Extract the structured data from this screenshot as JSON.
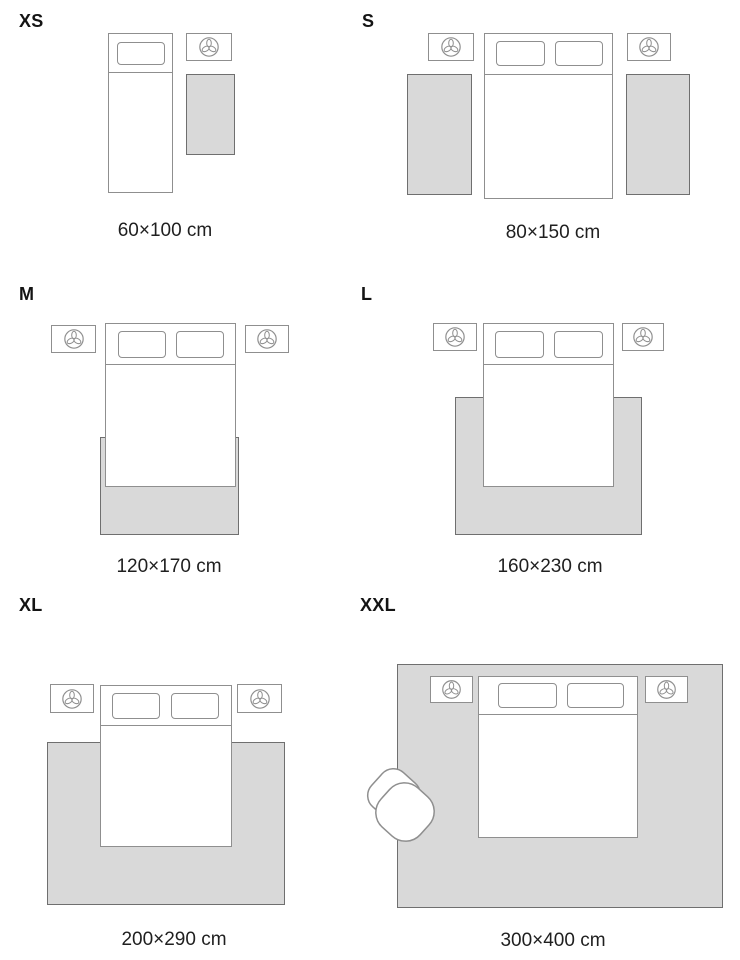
{
  "colors": {
    "background": "#ffffff",
    "rug_fill": "#d9d9d9",
    "rug_border": "#6f6f6f",
    "furniture_outline": "#8f8f8f",
    "text": "#1f1f1f"
  },
  "icons": {
    "nightstand_icon": "plant-icon",
    "armchair": "armchair"
  },
  "sizes": [
    {
      "label": "XS",
      "dimension": "60×100 cm"
    },
    {
      "label": "S",
      "dimension": "80×150 cm"
    },
    {
      "label": "M",
      "dimension": "120×170 cm"
    },
    {
      "label": "L",
      "dimension": "160×230 cm"
    },
    {
      "label": "XL",
      "dimension": "200×290 cm"
    },
    {
      "label": "XXL",
      "dimension": "300×400 cm"
    }
  ]
}
